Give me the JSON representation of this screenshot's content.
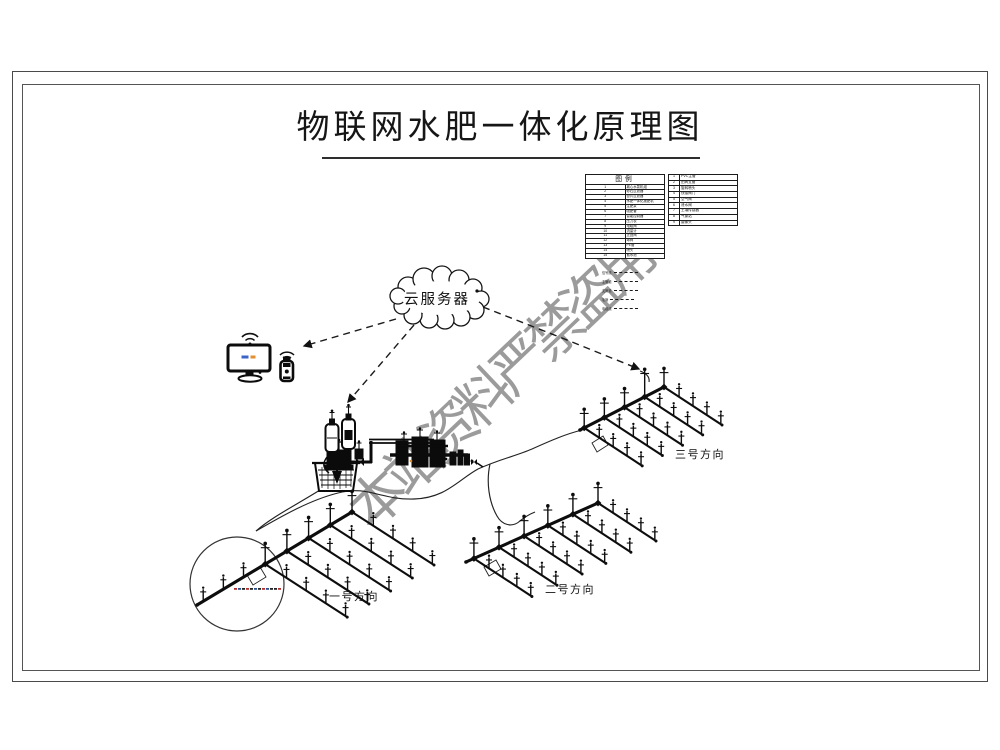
{
  "page": {
    "title": "物联网水肥一体化原理图"
  },
  "watermark": {
    "text": "本站资料严禁盗用",
    "color": "#8a8a8a"
  },
  "cloud": {
    "label": "云服务器"
  },
  "icons": {
    "cloud": "cloud-icon",
    "wifi": "wifi-icon",
    "monitor": "monitor-icon",
    "usb_dongle": "usb-dongle-icon",
    "water_basin": "water-basin-icon",
    "pump": "pump-icon",
    "dosing_tank": "dosing-tank-icon",
    "sprinkler": "sprinkler-icon"
  },
  "colors": {
    "ink": "#111111",
    "frame": "#4a4a4a",
    "watermark": "#8a8a8a",
    "screen_blue": "#3a66c9",
    "screen_orange": "#e2902f"
  },
  "legend": {
    "left": {
      "header": "图例",
      "rows": [
        [
          "1",
          "离心水泵机组"
        ],
        [
          "2",
          "砂石过滤器"
        ],
        [
          "3",
          "叠片过滤器"
        ],
        [
          "4",
          "水肥一体化施肥机"
        ],
        [
          "5",
          "注肥泵"
        ],
        [
          "6",
          "吸肥管"
        ],
        [
          "7",
          "智能控制器"
        ],
        [
          "8",
          "压力表"
        ],
        [
          "9",
          "电磁阀"
        ],
        [
          "10",
          "流量计"
        ],
        [
          "11",
          "止回阀"
        ],
        [
          "12",
          "球阀"
        ],
        [
          "13",
          "PE管"
        ],
        [
          "14",
          "喷头"
        ],
        [
          "15",
          "蓄水池"
        ]
      ]
    },
    "right": {
      "rows": [
        [
          "1",
          "PVC主管"
        ],
        [
          "2",
          "田间支管"
        ],
        [
          "3",
          "旋转喷头"
        ],
        [
          "4",
          "快接阀门"
        ],
        [
          "5",
          "空气阀"
        ],
        [
          "6",
          "泄水阀"
        ],
        [
          "7",
          "土壤传感器"
        ],
        [
          "8",
          "气象站"
        ],
        [
          "9",
          "摄像头"
        ]
      ]
    },
    "linetypes": [
      "信号线",
      "主管道",
      "支管道",
      "毛管",
      "电缆线"
    ]
  },
  "fields": [
    {
      "label": "一号方向"
    },
    {
      "label": "二号方向"
    },
    {
      "label": "三号方向"
    }
  ]
}
